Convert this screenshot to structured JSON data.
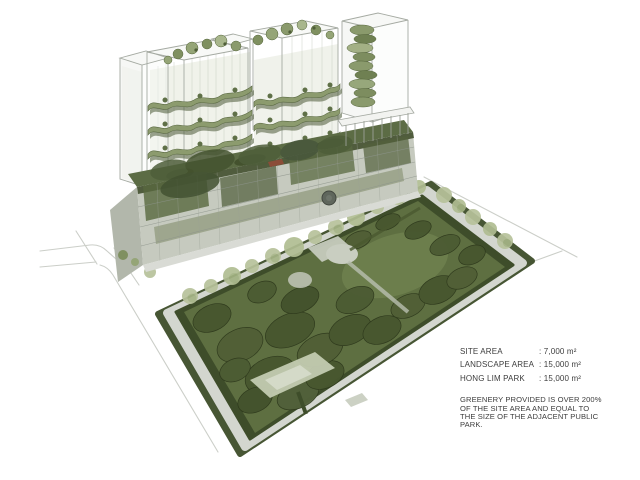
{
  "annotation": {
    "stats": [
      {
        "label": "SITE AREA",
        "value": ": 7,000 m²"
      },
      {
        "label": "LANDSCAPE AREA",
        "value": ": 15,000 m²"
      },
      {
        "label": "HONG LIM PARK",
        "value": ": 15,000 m²"
      }
    ],
    "note_lines": [
      "GREENERY PROVIDED IS OVER 200%",
      "OF THE SITE AREA AND EQUAL TO",
      "THE SIZE OF THE ADJACENT PUBLIC",
      "PARK."
    ]
  },
  "palette": {
    "background": "#ffffff",
    "park_lawn": "#5e6f41",
    "open_lawn": "#6e7f4e",
    "tree_canopy": "#47562f",
    "hedge": "#3e4d2a",
    "sidewalk": "#d3d6cf",
    "pale_tree": "#b7c29b",
    "terrace_green": "#8c9b6e",
    "terrace_shadow": "#4d5b39",
    "podium_gray": "#c6cabf",
    "glass_stroke": "#a5aaa2",
    "road_line": "#c9ccc6",
    "text": "#3d3d3d"
  }
}
